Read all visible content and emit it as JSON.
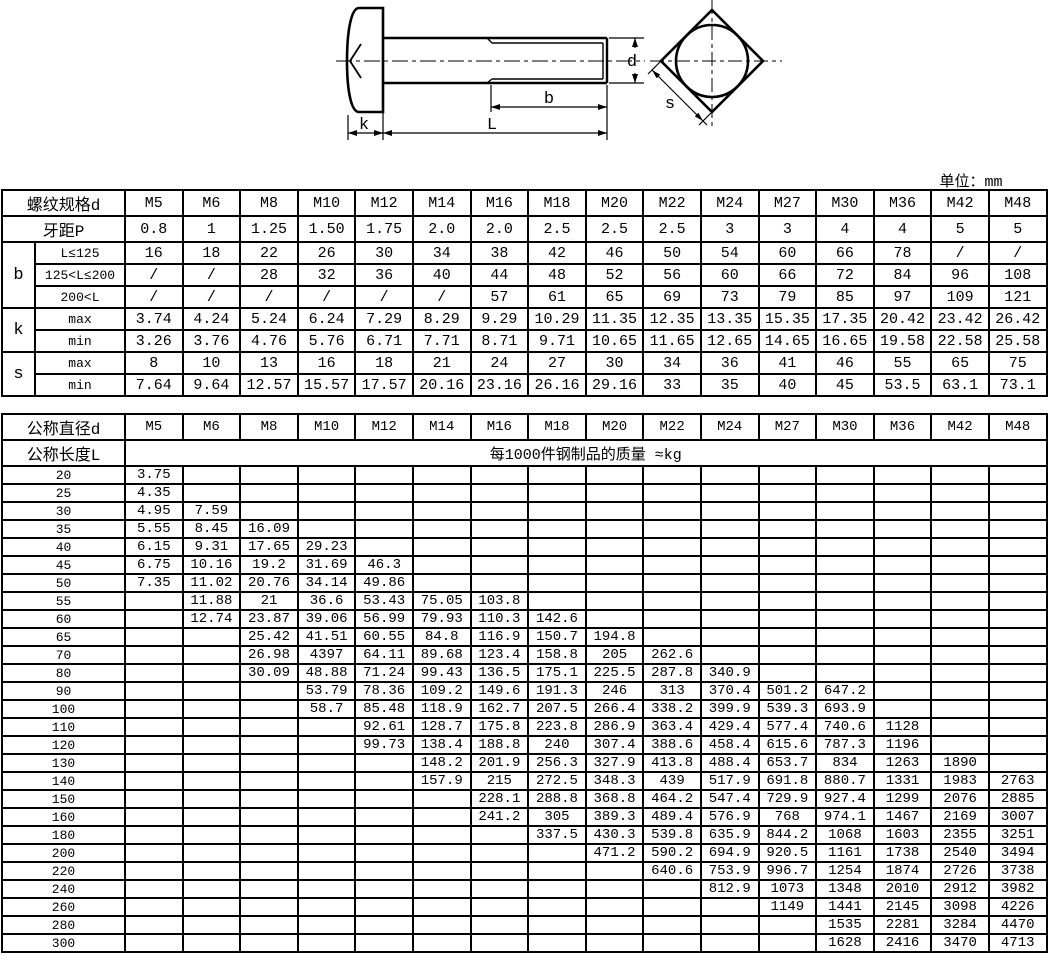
{
  "unit_label": "单位：mm",
  "drawing": {
    "labels": {
      "d": "d",
      "b": "b",
      "L": "L",
      "k": "k",
      "s": "s"
    }
  },
  "spec_table": {
    "header_label": "螺纹规格d",
    "pitch_label": "牙距P",
    "sizes": [
      "M5",
      "M6",
      "M8",
      "M10",
      "M12",
      "M14",
      "M16",
      "M18",
      "M20",
      "M22",
      "M24",
      "M27",
      "M30",
      "M36",
      "M42",
      "M48"
    ],
    "pitch": [
      "0.8",
      "1",
      "1.25",
      "1.50",
      "1.75",
      "2.0",
      "2.0",
      "2.5",
      "2.5",
      "2.5",
      "3",
      "3",
      "4",
      "4",
      "5",
      "5"
    ],
    "groups": [
      {
        "label": "b",
        "rows": [
          {
            "label": "L≤125",
            "values": [
              "16",
              "18",
              "22",
              "26",
              "30",
              "34",
              "38",
              "42",
              "46",
              "50",
              "54",
              "60",
              "66",
              "78",
              "/",
              "/"
            ]
          },
          {
            "label": "125<L≤200",
            "values": [
              "/",
              "/",
              "28",
              "32",
              "36",
              "40",
              "44",
              "48",
              "52",
              "56",
              "60",
              "66",
              "72",
              "84",
              "96",
              "108"
            ]
          },
          {
            "label": "200<L",
            "values": [
              "/",
              "/",
              "/",
              "/",
              "/",
              "/",
              "57",
              "61",
              "65",
              "69",
              "73",
              "79",
              "85",
              "97",
              "109",
              "121"
            ]
          }
        ]
      },
      {
        "label": "k",
        "rows": [
          {
            "label": "max",
            "values": [
              "3.74",
              "4.24",
              "5.24",
              "6.24",
              "7.29",
              "8.29",
              "9.29",
              "10.29",
              "11.35",
              "12.35",
              "13.35",
              "15.35",
              "17.35",
              "20.42",
              "23.42",
              "26.42"
            ]
          },
          {
            "label": "min",
            "values": [
              "3.26",
              "3.76",
              "4.76",
              "5.76",
              "6.71",
              "7.71",
              "8.71",
              "9.71",
              "10.65",
              "11.65",
              "12.65",
              "14.65",
              "16.65",
              "19.58",
              "22.58",
              "25.58"
            ]
          }
        ]
      },
      {
        "label": "s",
        "rows": [
          {
            "label": "max",
            "values": [
              "8",
              "10",
              "13",
              "16",
              "18",
              "21",
              "24",
              "27",
              "30",
              "34",
              "36",
              "41",
              "46",
              "55",
              "65",
              "75"
            ]
          },
          {
            "label": "min",
            "values": [
              "7.64",
              "9.64",
              "12.57",
              "15.57",
              "17.57",
              "20.16",
              "23.16",
              "26.16",
              "29.16",
              "33",
              "35",
              "40",
              "45",
              "53.5",
              "63.1",
              "73.1"
            ]
          }
        ]
      }
    ]
  },
  "mass_table": {
    "diameter_label": "公称直径d",
    "length_label": "公称长度L",
    "mass_note": "每1000件钢制品的质量 ≈kg",
    "sizes": [
      "M5",
      "M6",
      "M8",
      "M10",
      "M12",
      "M14",
      "M16",
      "M18",
      "M20",
      "M22",
      "M24",
      "M27",
      "M30",
      "M36",
      "M42",
      "M48"
    ],
    "rows": [
      {
        "length": "20",
        "values": [
          "3.75",
          "",
          "",
          "",
          "",
          "",
          "",
          "",
          "",
          "",
          "",
          "",
          "",
          "",
          "",
          ""
        ]
      },
      {
        "length": "25",
        "values": [
          "4.35",
          "",
          "",
          "",
          "",
          "",
          "",
          "",
          "",
          "",
          "",
          "",
          "",
          "",
          "",
          ""
        ]
      },
      {
        "length": "30",
        "values": [
          "4.95",
          "7.59",
          "",
          "",
          "",
          "",
          "",
          "",
          "",
          "",
          "",
          "",
          "",
          "",
          "",
          ""
        ]
      },
      {
        "length": "35",
        "values": [
          "5.55",
          "8.45",
          "16.09",
          "",
          "",
          "",
          "",
          "",
          "",
          "",
          "",
          "",
          "",
          "",
          "",
          ""
        ]
      },
      {
        "length": "40",
        "values": [
          "6.15",
          "9.31",
          "17.65",
          "29.23",
          "",
          "",
          "",
          "",
          "",
          "",
          "",
          "",
          "",
          "",
          "",
          ""
        ]
      },
      {
        "length": "45",
        "values": [
          "6.75",
          "10.16",
          "19.2",
          "31.69",
          "46.3",
          "",
          "",
          "",
          "",
          "",
          "",
          "",
          "",
          "",
          "",
          ""
        ]
      },
      {
        "length": "50",
        "values": [
          "7.35",
          "11.02",
          "20.76",
          "34.14",
          "49.86",
          "",
          "",
          "",
          "",
          "",
          "",
          "",
          "",
          "",
          "",
          ""
        ]
      },
      {
        "length": "55",
        "values": [
          "",
          "11.88",
          "21",
          "36.6",
          "53.43",
          "75.05",
          "103.8",
          "",
          "",
          "",
          "",
          "",
          "",
          "",
          "",
          ""
        ]
      },
      {
        "length": "60",
        "values": [
          "",
          "12.74",
          "23.87",
          "39.06",
          "56.99",
          "79.93",
          "110.3",
          "142.6",
          "",
          "",
          "",
          "",
          "",
          "",
          "",
          ""
        ]
      },
      {
        "length": "65",
        "values": [
          "",
          "",
          "25.42",
          "41.51",
          "60.55",
          "84.8",
          "116.9",
          "150.7",
          "194.8",
          "",
          "",
          "",
          "",
          "",
          "",
          ""
        ]
      },
      {
        "length": "70",
        "values": [
          "",
          "",
          "26.98",
          "4397",
          "64.11",
          "89.68",
          "123.4",
          "158.8",
          "205",
          "262.6",
          "",
          "",
          "",
          "",
          "",
          ""
        ]
      },
      {
        "length": "80",
        "values": [
          "",
          "",
          "30.09",
          "48.88",
          "71.24",
          "99.43",
          "136.5",
          "175.1",
          "225.5",
          "287.8",
          "340.9",
          "",
          "",
          "",
          "",
          ""
        ]
      },
      {
        "length": "90",
        "values": [
          "",
          "",
          "",
          "53.79",
          "78.36",
          "109.2",
          "149.6",
          "191.3",
          "246",
          "313",
          "370.4",
          "501.2",
          "647.2",
          "",
          "",
          ""
        ]
      },
      {
        "length": "100",
        "values": [
          "",
          "",
          "",
          "58.7",
          "85.48",
          "118.9",
          "162.7",
          "207.5",
          "266.4",
          "338.2",
          "399.9",
          "539.3",
          "693.9",
          "",
          "",
          ""
        ]
      },
      {
        "length": "110",
        "values": [
          "",
          "",
          "",
          "",
          "92.61",
          "128.7",
          "175.8",
          "223.8",
          "286.9",
          "363.4",
          "429.4",
          "577.4",
          "740.6",
          "1128",
          "",
          ""
        ]
      },
      {
        "length": "120",
        "values": [
          "",
          "",
          "",
          "",
          "99.73",
          "138.4",
          "188.8",
          "240",
          "307.4",
          "388.6",
          "458.4",
          "615.6",
          "787.3",
          "1196",
          "",
          ""
        ]
      },
      {
        "length": "130",
        "values": [
          "",
          "",
          "",
          "",
          "",
          "148.2",
          "201.9",
          "256.3",
          "327.9",
          "413.8",
          "488.4",
          "653.7",
          "834",
          "1263",
          "1890",
          ""
        ]
      },
      {
        "length": "140",
        "values": [
          "",
          "",
          "",
          "",
          "",
          "157.9",
          "215",
          "272.5",
          "348.3",
          "439",
          "517.9",
          "691.8",
          "880.7",
          "1331",
          "1983",
          "2763"
        ]
      },
      {
        "length": "150",
        "values": [
          "",
          "",
          "",
          "",
          "",
          "",
          "228.1",
          "288.8",
          "368.8",
          "464.2",
          "547.4",
          "729.9",
          "927.4",
          "1299",
          "2076",
          "2885"
        ]
      },
      {
        "length": "160",
        "values": [
          "",
          "",
          "",
          "",
          "",
          "",
          "241.2",
          "305",
          "389.3",
          "489.4",
          "576.9",
          "768",
          "974.1",
          "1467",
          "2169",
          "3007"
        ]
      },
      {
        "length": "180",
        "values": [
          "",
          "",
          "",
          "",
          "",
          "",
          "",
          "337.5",
          "430.3",
          "539.8",
          "635.9",
          "844.2",
          "1068",
          "1603",
          "2355",
          "3251"
        ]
      },
      {
        "length": "200",
        "values": [
          "",
          "",
          "",
          "",
          "",
          "",
          "",
          "",
          "471.2",
          "590.2",
          "694.9",
          "920.5",
          "1161",
          "1738",
          "2540",
          "3494"
        ]
      },
      {
        "length": "220",
        "values": [
          "",
          "",
          "",
          "",
          "",
          "",
          "",
          "",
          "",
          "640.6",
          "753.9",
          "996.7",
          "1254",
          "1874",
          "2726",
          "3738"
        ]
      },
      {
        "length": "240",
        "values": [
          "",
          "",
          "",
          "",
          "",
          "",
          "",
          "",
          "",
          "",
          "812.9",
          "1073",
          "1348",
          "2010",
          "2912",
          "3982"
        ]
      },
      {
        "length": "260",
        "values": [
          "",
          "",
          "",
          "",
          "",
          "",
          "",
          "",
          "",
          "",
          "",
          "1149",
          "1441",
          "2145",
          "3098",
          "4226"
        ]
      },
      {
        "length": "280",
        "values": [
          "",
          "",
          "",
          "",
          "",
          "",
          "",
          "",
          "",
          "",
          "",
          "",
          "1535",
          "2281",
          "3284",
          "4470"
        ]
      },
      {
        "length": "300",
        "values": [
          "",
          "",
          "",
          "",
          "",
          "",
          "",
          "",
          "",
          "",
          "",
          "",
          "1628",
          "2416",
          "3470",
          "4713"
        ]
      }
    ]
  }
}
